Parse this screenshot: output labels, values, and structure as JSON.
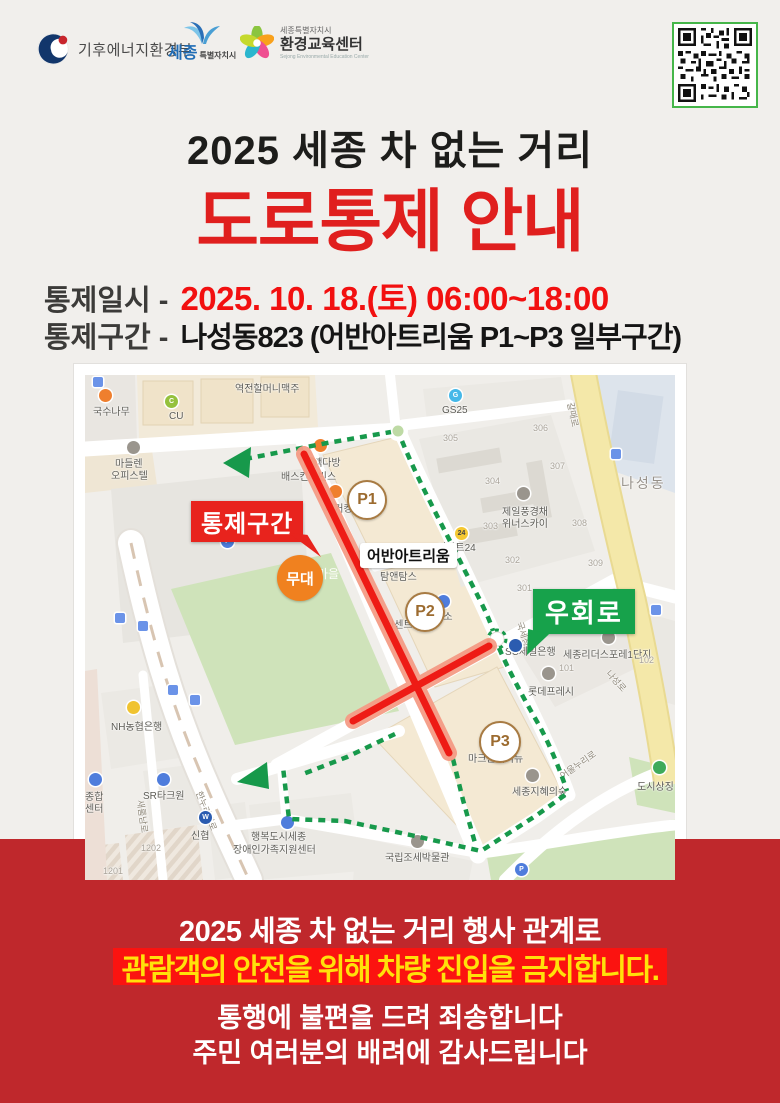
{
  "header": {
    "ministry": "기후에너지환경부",
    "city": {
      "main": "세종",
      "sub": "특별자치시"
    },
    "center": {
      "top": "세종특별자치시",
      "main": "환경교육센터",
      "eng": "Sejong Environmental Education Center"
    }
  },
  "title": {
    "line1": "2025 세종 차 없는 거리",
    "line2": "도로통제 안내"
  },
  "info": {
    "row1_label": "통제일시 -",
    "row1_value": "2025. 10. 18.(토) 06:00~18:00",
    "row2_label": "통제구간 -",
    "row2_value": "나성동823 (어반아트리움 P1~P3 일부구간)"
  },
  "map": {
    "annotations": {
      "control": "통제구간",
      "detour": "우회로",
      "stage": "무대",
      "complex": "어반아트리움",
      "p1": "P1",
      "p2": "P2",
      "p3": "P3"
    },
    "icon_colors": {
      "food": "#ef7f2e",
      "store": "#4f7ddc",
      "bank": "#f0c330",
      "bankblue": "#2b5cb0",
      "gray": "#9a958d",
      "green": "#3faa5a",
      "bus": "#6b93e8",
      "p": "#4f7ddc",
      "emart": "#f5c832",
      "cu": "#95c13d",
      "gs": "#45b8e8"
    },
    "labels": [
      {
        "t": "국수나무",
        "x": 8,
        "y": 28,
        "c": ""
      },
      {
        "t": "CU",
        "x": 84,
        "y": 36,
        "c": ""
      },
      {
        "t": "역전할머니맥주",
        "x": 150,
        "y": 5,
        "c": ""
      },
      {
        "t": "마들렌",
        "x": 30,
        "y": 80,
        "c": ""
      },
      {
        "t": "오피스텔",
        "x": 26,
        "y": 92,
        "c": ""
      },
      {
        "t": "GS25",
        "x": 357,
        "y": 30,
        "c": ""
      },
      {
        "t": "305",
        "x": 358,
        "y": 58,
        "c": "num"
      },
      {
        "t": "306",
        "x": 448,
        "y": 48,
        "c": "num"
      },
      {
        "t": "304",
        "x": 400,
        "y": 101,
        "c": "num"
      },
      {
        "t": "307",
        "x": 465,
        "y": 86,
        "c": "num"
      },
      {
        "t": "303",
        "x": 398,
        "y": 146,
        "c": "num"
      },
      {
        "t": "308",
        "x": 487,
        "y": 143,
        "c": "num"
      },
      {
        "t": "302",
        "x": 420,
        "y": 180,
        "c": "num"
      },
      {
        "t": "309",
        "x": 503,
        "y": 183,
        "c": "num"
      },
      {
        "t": "301",
        "x": 432,
        "y": 208,
        "c": "num"
      },
      {
        "t": "나성동",
        "x": 536,
        "y": 98,
        "c": "district"
      },
      {
        "t": "갈매로",
        "x": 492,
        "y": 26,
        "c": "road",
        "r": 78
      },
      {
        "t": "제일풍경채",
        "x": 417,
        "y": 128,
        "c": ""
      },
      {
        "t": "위너스카이",
        "x": 417,
        "y": 140,
        "c": ""
      },
      {
        "t": "이마트24",
        "x": 352,
        "y": 164,
        "c": ""
      },
      {
        "t": "빽다방",
        "x": 228,
        "y": 79,
        "c": ""
      },
      {
        "t": "배스킨라빈스",
        "x": 196,
        "y": 93,
        "c": ""
      },
      {
        "t": "버거킹",
        "x": 240,
        "y": 125,
        "c": ""
      },
      {
        "t": "탐앤탐스",
        "x": 295,
        "y": 193,
        "c": ""
      },
      {
        "t": "더센트럴",
        "x": 300,
        "y": 241,
        "c": ""
      },
      {
        "t": "다이소",
        "x": 340,
        "y": 233,
        "c": ""
      },
      {
        "t": "국세청로",
        "x": 441,
        "y": 245,
        "c": "road",
        "r": 72
      },
      {
        "t": "SC제일은행",
        "x": 420,
        "y": 268,
        "c": ""
      },
      {
        "t": "세종리더스포레1단지",
        "x": 478,
        "y": 271,
        "c": ""
      },
      {
        "t": "101",
        "x": 474,
        "y": 288,
        "c": "num"
      },
      {
        "t": "102",
        "x": 554,
        "y": 280,
        "c": "num"
      },
      {
        "t": "나성로",
        "x": 528,
        "y": 292,
        "c": "road",
        "r": 48
      },
      {
        "t": "롯데프레시",
        "x": 443,
        "y": 308,
        "c": ""
      },
      {
        "t": "마크원애비뉴",
        "x": 383,
        "y": 375,
        "c": ""
      },
      {
        "t": "세종지혜의숲",
        "x": 427,
        "y": 408,
        "c": ""
      },
      {
        "t": "도시상징",
        "x": 552,
        "y": 403,
        "c": ""
      },
      {
        "t": "어울누리로",
        "x": 472,
        "y": 396,
        "c": "road",
        "r": -35
      },
      {
        "t": "NH농협은행",
        "x": 26,
        "y": 343,
        "c": ""
      },
      {
        "t": "종합",
        "x": 0,
        "y": 413,
        "c": ""
      },
      {
        "t": "센터",
        "x": 0,
        "y": 425,
        "c": ""
      },
      {
        "t": "SR타크원",
        "x": 58,
        "y": 412,
        "c": ""
      },
      {
        "t": "신협",
        "x": 106,
        "y": 452,
        "c": ""
      },
      {
        "t": "행복도시세종",
        "x": 166,
        "y": 453,
        "c": ""
      },
      {
        "t": "장애인가족지원센터",
        "x": 148,
        "y": 466,
        "c": ""
      },
      {
        "t": "1202",
        "x": 56,
        "y": 468,
        "c": "num"
      },
      {
        "t": "1201",
        "x": 18,
        "y": 491,
        "c": "num"
      },
      {
        "t": "국립조세박물관",
        "x": 300,
        "y": 474,
        "c": ""
      },
      {
        "t": "한누리대로",
        "x": 120,
        "y": 414,
        "c": "road",
        "r": 68
      },
      {
        "t": "새롬남로",
        "x": 62,
        "y": 424,
        "c": "road",
        "r": 82
      },
      {
        "t": "마을",
        "x": 232,
        "y": 190,
        "c": "parkname"
      },
      {
        "t": "행정",
        "x": 592,
        "y": 128,
        "c": ""
      }
    ],
    "icons": [
      {
        "x": 14,
        "y": 14,
        "c": "food"
      },
      {
        "x": 80,
        "y": 20,
        "c": "cu",
        "g": "C"
      },
      {
        "x": 364,
        "y": 14,
        "c": "gs",
        "g": "G"
      },
      {
        "x": 229,
        "y": 64,
        "c": "food"
      },
      {
        "x": 219,
        "y": 82,
        "c": "food"
      },
      {
        "x": 244,
        "y": 110,
        "c": "food"
      },
      {
        "x": 42,
        "y": 66,
        "c": "gray"
      },
      {
        "x": 432,
        "y": 112,
        "c": "gray"
      },
      {
        "x": 370,
        "y": 152,
        "c": "emart",
        "g": "24"
      },
      {
        "x": 352,
        "y": 220,
        "c": "store"
      },
      {
        "x": 517,
        "y": 256,
        "c": "gray"
      },
      {
        "x": 424,
        "y": 264,
        "c": "bankblue"
      },
      {
        "x": 457,
        "y": 292,
        "c": "gray"
      },
      {
        "x": 42,
        "y": 326,
        "c": "bank"
      },
      {
        "x": 114,
        "y": 436,
        "c": "bankblue",
        "g": "W"
      },
      {
        "x": 72,
        "y": 398,
        "c": "store"
      },
      {
        "x": 196,
        "y": 441,
        "c": "store"
      },
      {
        "x": 4,
        "y": 398,
        "c": "store"
      },
      {
        "x": 441,
        "y": 394,
        "c": "gray"
      },
      {
        "x": 326,
        "y": 460,
        "c": "gray"
      },
      {
        "x": 568,
        "y": 386,
        "c": "green"
      },
      {
        "x": 136,
        "y": 160,
        "c": "p",
        "g": "P"
      },
      {
        "x": 430,
        "y": 488,
        "c": "p",
        "g": "P"
      },
      {
        "x": 30,
        "y": 238,
        "c": "bus",
        "sq": 1
      },
      {
        "x": 53,
        "y": 246,
        "c": "bus",
        "sq": 1
      },
      {
        "x": 83,
        "y": 310,
        "c": "bus",
        "sq": 1
      },
      {
        "x": 105,
        "y": 320,
        "c": "bus",
        "sq": 1
      },
      {
        "x": 526,
        "y": 74,
        "c": "bus",
        "sq": 1
      },
      {
        "x": 566,
        "y": 230,
        "c": "bus",
        "sq": 1
      },
      {
        "x": 8,
        "y": 2,
        "c": "bus",
        "sq": 1
      }
    ]
  },
  "footer": {
    "line1": "2025 세종 차 없는 거리 행사 관계로",
    "highlight": "관람객의 안전을 위해 차량 진입을 금지합니다.",
    "line3": "통행에 불편을 드려 죄송합니다",
    "line4": "주민 여러분의 배려에 감사드립니다"
  },
  "colors": {
    "page_bg": "#f1efec",
    "footer_bg": "#bf282c",
    "highlight_bg": "#fb1310",
    "highlight_text": "#ffe10a",
    "title_red": "#e01f1e",
    "control_red": "#ee1b15",
    "detour_green": "#17994b",
    "qr_border": "#45b649"
  }
}
